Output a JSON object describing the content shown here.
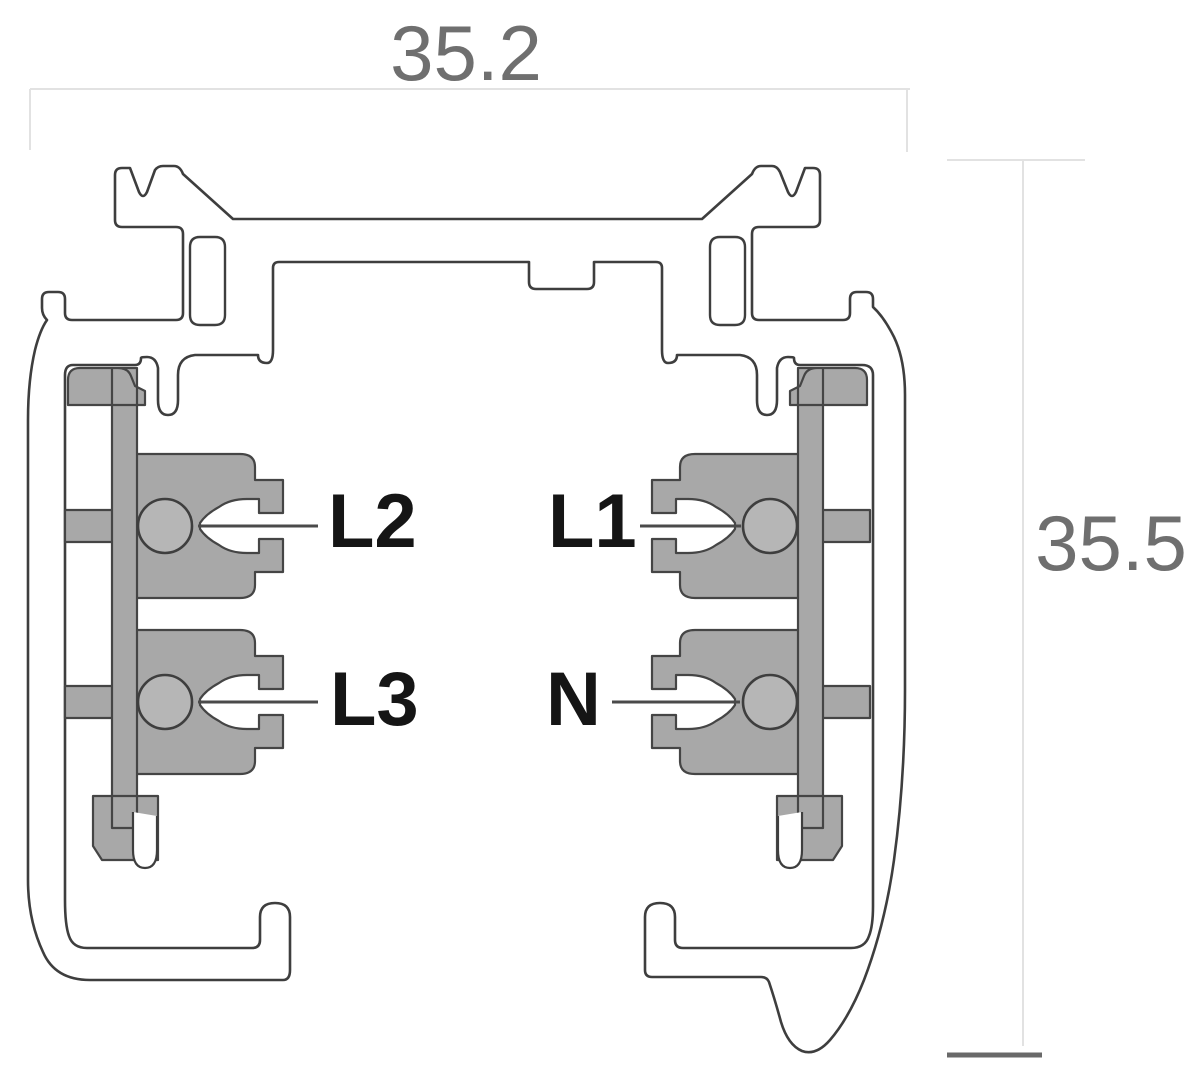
{
  "diagram": {
    "type": "track-profile-cross-section",
    "description": "Cross-section drawing of a 3-circuit lighting track profile with insulators, conductor contacts and overall dimensions",
    "dimensions": {
      "width": {
        "label": "35.2"
      },
      "height": {
        "label": "35.5"
      }
    },
    "conductors": [
      {
        "id": "L2",
        "label": "L2",
        "side": "left",
        "row": "upper"
      },
      {
        "id": "L1",
        "label": "L1",
        "side": "right",
        "row": "upper"
      },
      {
        "id": "L3",
        "label": "L3",
        "side": "left",
        "row": "lower"
      },
      {
        "id": "N",
        "label": "N",
        "side": "right",
        "row": "lower"
      }
    ],
    "colors": {
      "outline": "#3e3e3e",
      "insulator_fill": "#a8a8a8",
      "contact_fill": "#b6b6b6",
      "label_text": "#151515",
      "dimension_text": "#6f6f6f",
      "dimension_line_light": "#e2e2e2",
      "dimension_tick_dark": "#696969",
      "leader_line": "#4a4a4a",
      "background": "#ffffff"
    }
  }
}
